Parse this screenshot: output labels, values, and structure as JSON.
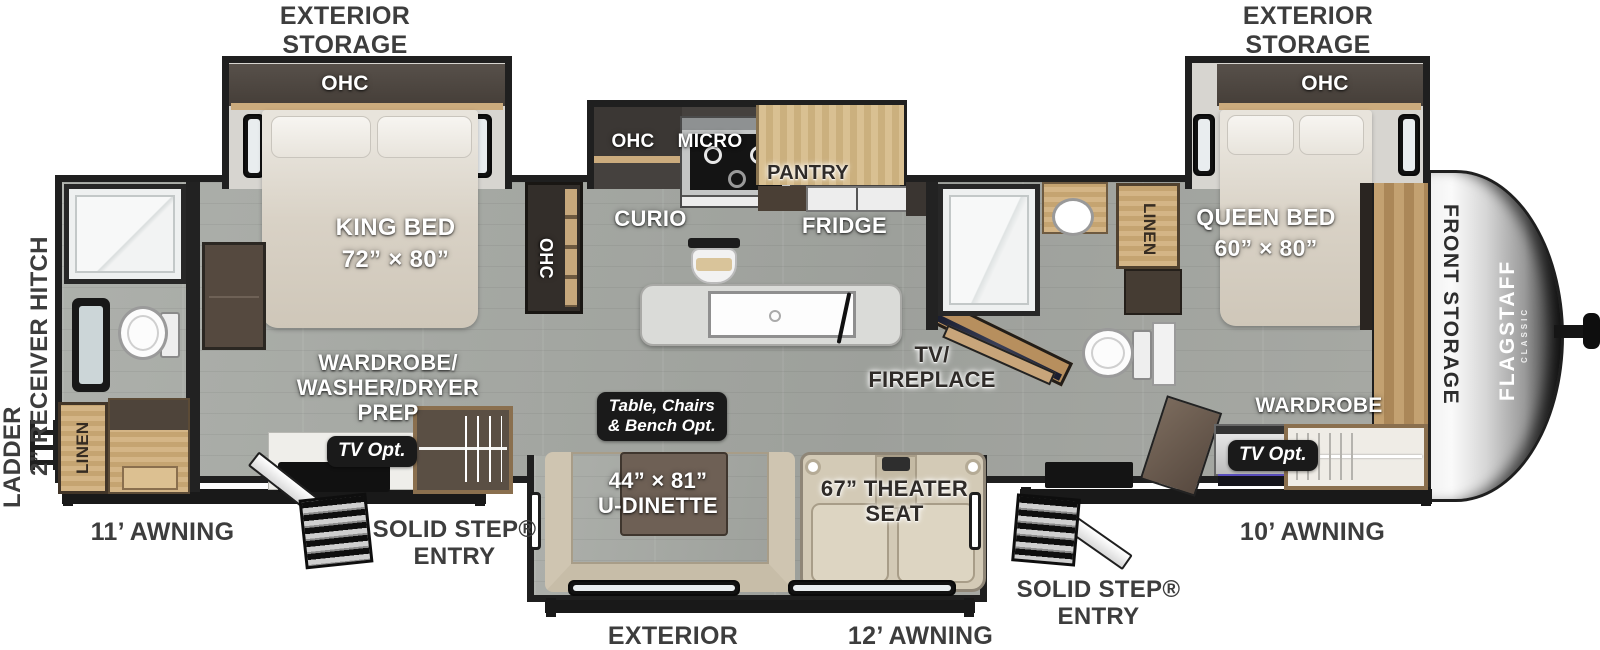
{
  "brand": {
    "name": "FLAGSTAFF",
    "series": "CLASSIC"
  },
  "exterior": {
    "storage_top_left": "EXTERIOR\nSTORAGE",
    "storage_top_right": "EXTERIOR\nSTORAGE",
    "storage_bottom": "EXTERIOR STORAGE",
    "awning_rear": "11’ AWNING",
    "awning_door_side": "12’ AWNING",
    "awning_front": "10’ AWNING",
    "entry_rear": "SOLID STEP®\nENTRY",
    "entry_front": "SOLID STEP®\nENTRY",
    "ladder": "LADDER",
    "receiver_hitch": "2” RECEIVER HITCH",
    "front_storage": "FRONT STORAGE"
  },
  "rear_bedroom": {
    "ohc": "OHC",
    "bed": "KING BED\n72” × 80”",
    "wardrobe_prep": "WARDROBE/\nWASHER/DRYER\nPREP",
    "tv_opt": "TV Opt.",
    "ohc_cabinet": "OHC"
  },
  "rear_bath": {
    "linen": "LINEN"
  },
  "kitchen": {
    "curio": "CURIO",
    "ohc": "OHC",
    "micro": "MICRO",
    "pantry": "PANTRY",
    "fridge": "FRIDGE"
  },
  "living": {
    "tv_fireplace": "TV/\nFIREPLACE",
    "dinette_option": "Table, Chairs\n& Bench  Opt.",
    "dinette": "44” × 81”\nU-DINETTE",
    "theater_seat": "67” THEATER\nSEAT"
  },
  "mid_bath": {
    "linen": "LINEN"
  },
  "front_bedroom": {
    "ohc": "OHC",
    "bed": "QUEEN BED\n60” × 80”",
    "wardrobe": "WARDROBE",
    "tv_opt": "TV Opt."
  }
}
